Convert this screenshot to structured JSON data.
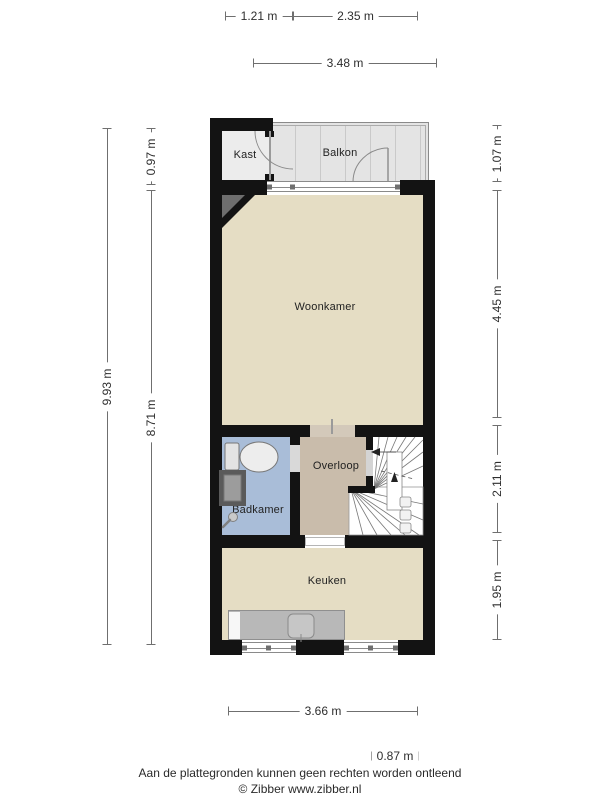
{
  "rooms": {
    "kast": "Kast",
    "balkon": "Balkon",
    "woonkamer": "Woonkamer",
    "overloop": "Overloop",
    "badkamer": "Badkamer",
    "keuken": "Keuken"
  },
  "dims": {
    "top": [
      "1.21 m",
      "2.35 m",
      "3.48 m"
    ],
    "left": [
      "9.93 m",
      "0.97 m",
      "8.71 m"
    ],
    "right": [
      "1.07 m",
      "4.45 m",
      "2.11 m",
      "1.95 m"
    ],
    "bottom": [
      "3.66 m",
      "0.87 m"
    ]
  },
  "footer": {
    "disclaimer": "Aan de plattegronden kunnen geen rechten worden ontleend",
    "credit": "© Zibber www.zibber.nl"
  },
  "icons": [
    "stairs-icon",
    "toilet-icon",
    "washbasin-icon",
    "shower-icon",
    "sink-icon",
    "door-arc-icon"
  ],
  "colors": {
    "wall": "#131313",
    "living_floor": "#e5ddc4",
    "hall_floor": "#c9bcab",
    "bathroom_floor": "#a9bdd8",
    "closet_floor": "#ececec",
    "balcony_floor": "#e4e4e4",
    "counter": "#b8b8b8",
    "shaft": "#6e6e6e"
  }
}
